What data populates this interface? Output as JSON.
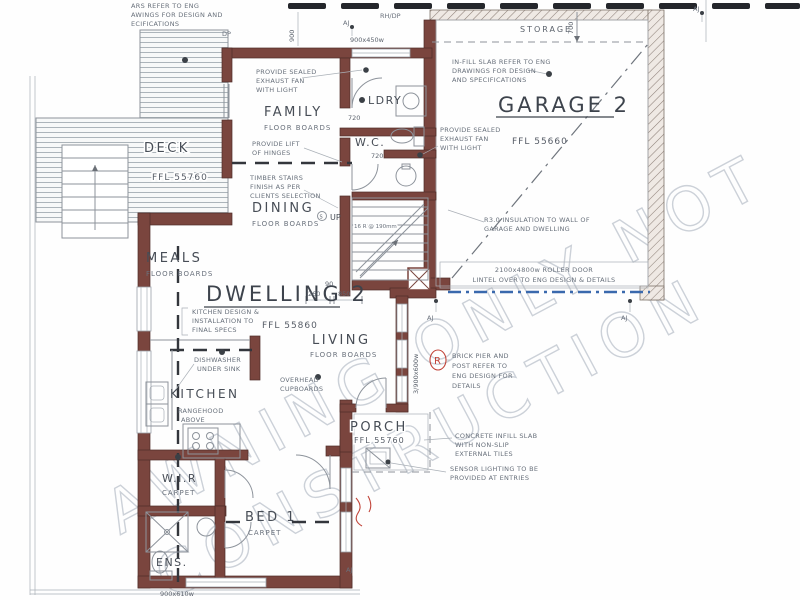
{
  "colors": {
    "wall": "#7a453e",
    "line": "#8d939b",
    "roller_door_blue": "#3a69ad",
    "boundary_dash": "#24262b",
    "markup_red": "#c14338",
    "watermark": "#b7bec9"
  },
  "rooms": {
    "garage": {
      "name": "GARAGE 2",
      "ffl": "FFL 55660"
    },
    "dwelling": {
      "name": "DWELLING 2",
      "ffl": "FFL 55860"
    },
    "family": {
      "name": "FAMILY",
      "floor": "FLOOR BOARDS"
    },
    "dining": {
      "name": "DINING",
      "floor": "FLOOR BOARDS"
    },
    "meals": {
      "name": "MEALS",
      "floor": "FLOOR BOARDS"
    },
    "living": {
      "name": "LIVING",
      "floor": "FLOOR BOARDS"
    },
    "kitchen": {
      "name": "KITCHEN",
      "note1": "RANGEHOOD",
      "note2": "ABOVE"
    },
    "ldry": {
      "name": "LDRY"
    },
    "wc": {
      "name": "W.C."
    },
    "deck": {
      "name": "DECK",
      "ffl": "FFL 55760"
    },
    "porch": {
      "name": "PORCH",
      "ffl": "FFL 55760"
    },
    "storage": {
      "name": "STORAGE"
    },
    "bed1": {
      "name": "BED 1",
      "floor": "CARPET"
    },
    "wir": {
      "name": "W.I.R",
      "floor": "CARPET"
    },
    "ens": {
      "name": "ENS."
    }
  },
  "annotations": {
    "top_left": [
      "ARS REFER TO ENG",
      "AWINGS FOR DESIGN AND",
      "ECIFICATIONS"
    ],
    "sealed_fan_1": [
      "PROVIDE SEALED",
      "EXHAUST FAN",
      "WITH LIGHT"
    ],
    "sealed_fan_2": [
      "PROVIDE SEALED",
      "EXHAUST FAN",
      "WITH LIGHT"
    ],
    "infill_slab": [
      "IN-FILL SLAB REFER TO ENG",
      "DRAWINGS FOR DESIGN",
      "AND SPECIFICATIONS"
    ],
    "insulation": [
      "R3.0 INSULATION TO WALL OF",
      "GARAGE AND DWELLING"
    ],
    "roller_door": [
      "2100x4800w ROLLER DOOR",
      "LINTEL OVER TO ENG DESIGN & DETAILS"
    ],
    "lift_hinges": [
      "PROVIDE LIFT",
      "OF HINGES"
    ],
    "timber_stairs": [
      "TIMBER STAIRS",
      "FINISH AS PER",
      "CLIENTS SELECTION"
    ],
    "kitchen_spec": [
      "KITCHEN DESIGN &",
      "INSTALLATION TO",
      "FINAL SPECS"
    ],
    "dishwasher": [
      "DISHWASHER",
      "UNDER SINK"
    ],
    "overhead": [
      "OVERHEAD",
      "CUPBOARDS"
    ],
    "brick_pier": [
      "BRICK PIER AND",
      "POST REFER TO",
      "ENG DESIGN FOR",
      "DETAILS"
    ],
    "concrete": [
      "CONCRETE INFILL SLAB",
      "WITH NON-SLIP",
      "EXTERNAL TILES"
    ],
    "sensor": [
      "SENSOR LIGHTING TO BE",
      "PROVIDED AT ENTRIES"
    ],
    "stairs_note": "16 R @ 190mm",
    "up": "UP"
  },
  "dimensions": {
    "d90": "90",
    "d260": "260",
    "d850": "850",
    "d700": "700",
    "d900": "900",
    "win_ldry": "900x450w",
    "win_living": "3/900x600w",
    "win_bed": "900x610w",
    "door_720a": "720",
    "door_720b": "720"
  },
  "markers": {
    "aj": "AJ",
    "dp": "DP",
    "rhdp": "RH/DP",
    "s": "S",
    "red_r": "R"
  },
  "watermark": {
    "line1": "AWNING ONLY NOT",
    "line2": "CONSTRUCTION"
  }
}
